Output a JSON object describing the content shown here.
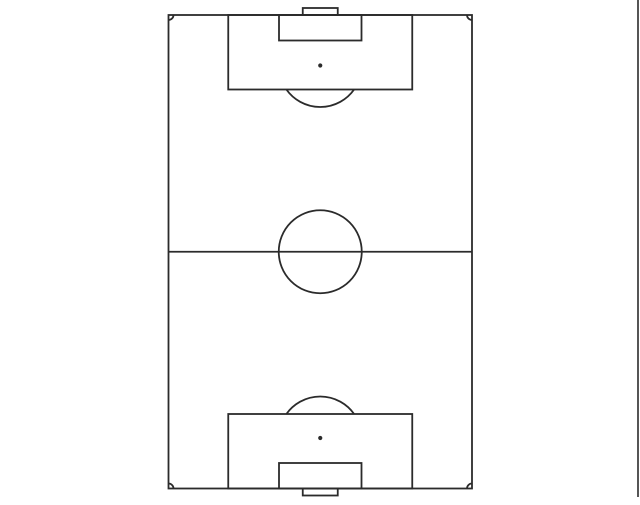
{
  "app": {
    "canvas_width": 640,
    "canvas_height": 505,
    "background_color": "#ffffff"
  },
  "drawing": {
    "shape_name": "soccer-football-field-vertical",
    "line_color": "#2b2b2b",
    "line_width": 1.8,
    "fill_color": "none",
    "page_border": {
      "x": 638,
      "y1": 0,
      "y2": 497,
      "color": "#2b2b2b",
      "width": 1.6
    },
    "pitch": {
      "left": 168.5,
      "top": 15,
      "width": 303.5,
      "height": 473.5,
      "penalty_area": {
        "width": 184,
        "depth": 74.5
      },
      "goal_area": {
        "width": 82.5,
        "depth": 25.5
      },
      "goal": {
        "width": 35,
        "depth": 7
      },
      "penalty_spot_distance": 50.5,
      "penalty_spot_radius": 2.1,
      "center_circle_radius": 41.5,
      "corner_arc_radius": 5
    }
  }
}
